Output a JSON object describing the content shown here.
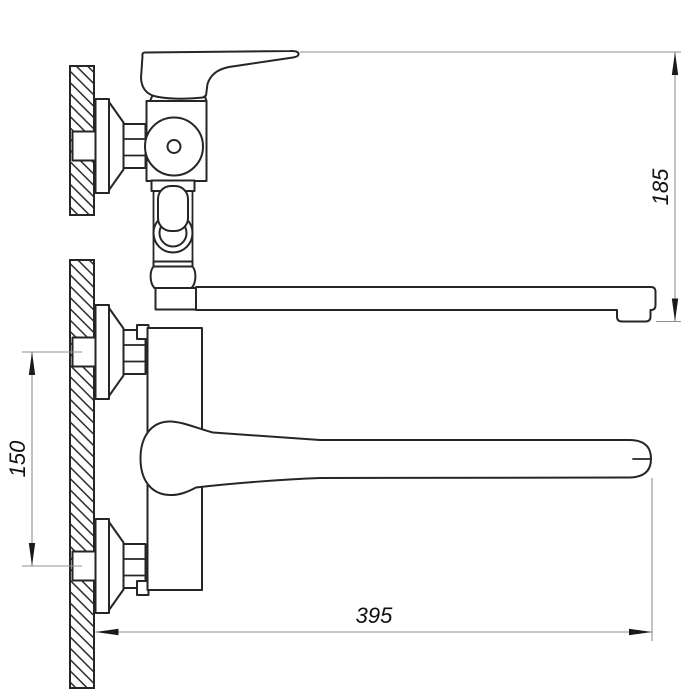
{
  "drawing": {
    "kind": "technical dimension drawing",
    "subject": "wall-mounted single-lever mixer faucet with long straight spout, side view (top) and front view (bottom)",
    "colors": {
      "background": "#ffffff",
      "outline": "#262626",
      "dimension_lines": "#8f8f8f",
      "text": "#111111"
    },
    "dimensions": {
      "spout_drop_height": {
        "label": "185"
      },
      "wall_connection_spacing": {
        "label": "150"
      },
      "spout_length": {
        "label": "395"
      }
    }
  }
}
